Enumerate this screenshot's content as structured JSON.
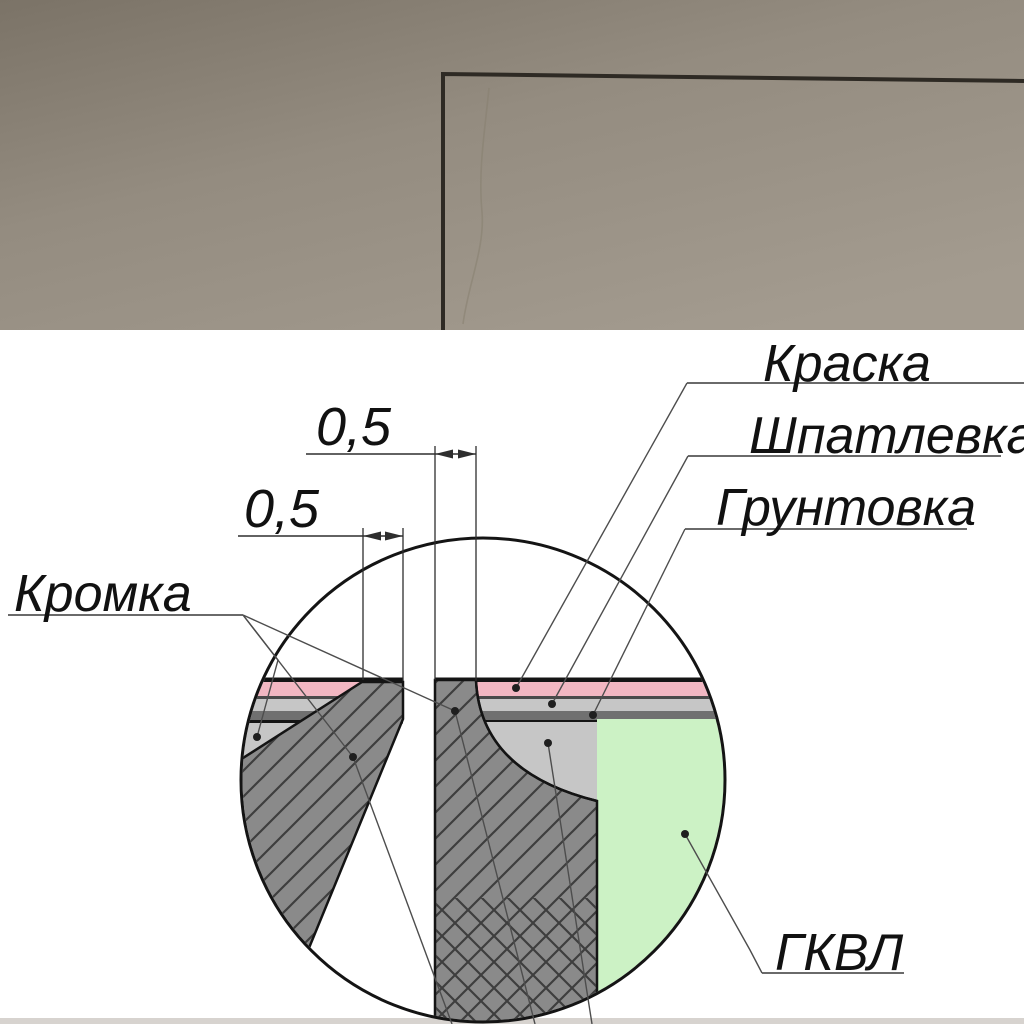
{
  "diagram": {
    "labels": {
      "paint": "Краска",
      "filler": "Шпатлевка",
      "primer": "Грунтовка",
      "edge": "Кромка",
      "board": "ГКВЛ"
    },
    "dimensions": {
      "recess_width": "0,5",
      "edge_width": "0,5"
    },
    "colors": {
      "paint_layer": "#f2b7c2",
      "filler_layer": "#c6c6c6",
      "primer_layer": "#707070",
      "board_fill": "#ccf2c5",
      "gypsum_fill": "#8a8a8a",
      "outline": "#141414"
    }
  },
  "photo": {
    "colors": {
      "plaster_dark": "#7b7367",
      "plaster_mid": "#948c80",
      "plaster_light": "#a39b8f",
      "shadow_gap": "#2e2a24"
    }
  }
}
